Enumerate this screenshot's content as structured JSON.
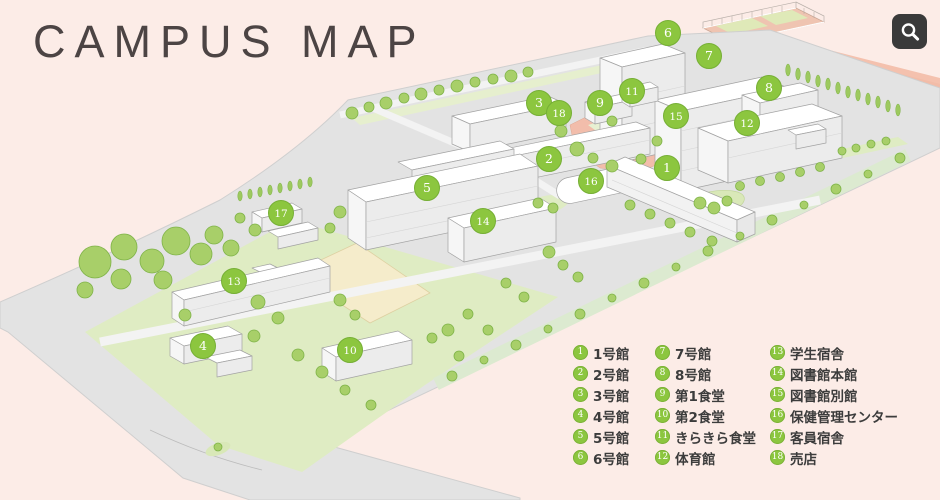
{
  "title": "CAMPUS MAP",
  "zoom_button": {
    "icon": "magnifier-icon"
  },
  "colors": {
    "background": "#fcece7",
    "salmon_field": "#f4c1ae",
    "plaza": "#f2bdab",
    "lawn": "#dfecc3",
    "tree": "#a8cf69",
    "ground": "#e3e3e3",
    "marker_green": "#8cc63f",
    "legend_text": "#3c3c3c",
    "title_text": "#4c4444",
    "zoom_button_bg": "#3a3a3a"
  },
  "map": {
    "markers": [
      {
        "n": 1,
        "x": 667,
        "y": 168,
        "label": "1号館"
      },
      {
        "n": 2,
        "x": 549,
        "y": 159,
        "label": "2号館"
      },
      {
        "n": 3,
        "x": 539,
        "y": 103,
        "label": "3号館"
      },
      {
        "n": 4,
        "x": 203,
        "y": 346,
        "label": "4号館"
      },
      {
        "n": 5,
        "x": 427,
        "y": 188,
        "label": "5号館"
      },
      {
        "n": 6,
        "x": 668,
        "y": 33,
        "label": "6号館"
      },
      {
        "n": 7,
        "x": 709,
        "y": 56,
        "label": "7号館"
      },
      {
        "n": 8,
        "x": 769,
        "y": 88,
        "label": "8号館"
      },
      {
        "n": 9,
        "x": 600,
        "y": 103,
        "label": "第1食堂"
      },
      {
        "n": 10,
        "x": 350,
        "y": 350,
        "label": "第2食堂"
      },
      {
        "n": 11,
        "x": 632,
        "y": 91,
        "label": "きらきら食堂"
      },
      {
        "n": 12,
        "x": 747,
        "y": 123,
        "label": "体育館"
      },
      {
        "n": 13,
        "x": 234,
        "y": 281,
        "label": "学生宿舎"
      },
      {
        "n": 14,
        "x": 483,
        "y": 221,
        "label": "図書館本館"
      },
      {
        "n": 15,
        "x": 676,
        "y": 116,
        "label": "図書館別館"
      },
      {
        "n": 16,
        "x": 591,
        "y": 181,
        "label": "保健管理センター"
      },
      {
        "n": 17,
        "x": 281,
        "y": 213,
        "label": "客員宿舎"
      },
      {
        "n": 18,
        "x": 559,
        "y": 113,
        "label": "売店"
      }
    ]
  },
  "legend": {
    "columns": [
      {
        "items": [
          {
            "n": 1,
            "label": "1号館"
          },
          {
            "n": 2,
            "label": "2号館"
          },
          {
            "n": 3,
            "label": "3号館"
          },
          {
            "n": 4,
            "label": "4号館"
          },
          {
            "n": 5,
            "label": "5号館"
          },
          {
            "n": 6,
            "label": "6号館"
          }
        ]
      },
      {
        "items": [
          {
            "n": 7,
            "label": "7号館"
          },
          {
            "n": 8,
            "label": "8号館"
          },
          {
            "n": 9,
            "label": "第1食堂"
          },
          {
            "n": 10,
            "label": "第2食堂"
          },
          {
            "n": 11,
            "label": "きらきら食堂"
          },
          {
            "n": 12,
            "label": "体育館"
          }
        ]
      },
      {
        "items": [
          {
            "n": 13,
            "label": "学生宿舎"
          },
          {
            "n": 14,
            "label": "図書館本館"
          },
          {
            "n": 15,
            "label": "図書館別館"
          },
          {
            "n": 16,
            "label": "保健管理センター"
          },
          {
            "n": 17,
            "label": "客員宿舎"
          },
          {
            "n": 18,
            "label": "売店"
          }
        ]
      }
    ]
  }
}
